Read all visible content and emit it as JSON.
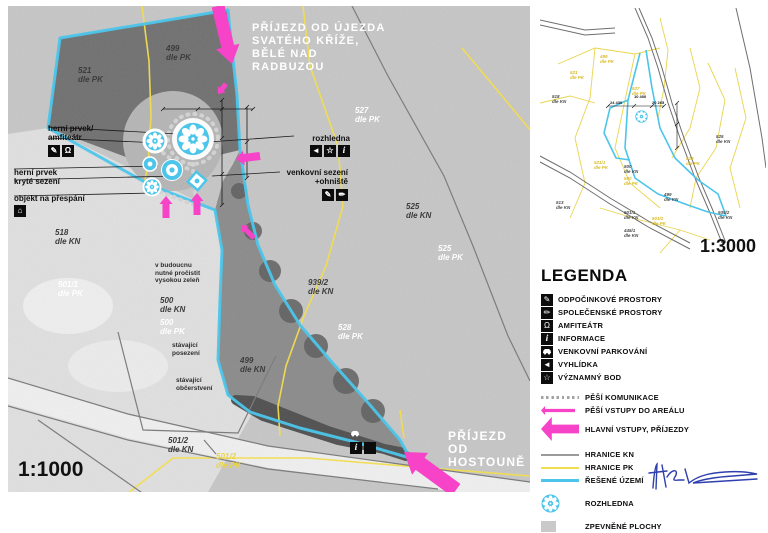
{
  "colors": {
    "magenta": "#f643c8",
    "cyan": "#4cc5ea",
    "yellow": "#f2dd4e",
    "kn_gray": "#8a8a8a",
    "photo_base": "#c6c6c6",
    "forest": "#6f6f6f",
    "paved": "#c9c9c9",
    "ink_blue": "#2f3fae"
  },
  "main_map": {
    "scale": "1:1000",
    "arrival_top": "PŘÍJEZD OD ÚJEZDA\nSVATÉHO KŘÍŽE,\nBĚLÉ NAD\nRADBUZOU",
    "arrival_bottom": "PŘÍJEZD OD\nHOSTOUNĚ",
    "parcels": [
      {
        "text": "521\ndle PK",
        "x": 70,
        "y": 60,
        "style": "dark"
      },
      {
        "text": "499\ndle PK",
        "x": 158,
        "y": 38,
        "style": "dark"
      },
      {
        "text": "527\ndle PK",
        "x": 347,
        "y": 100,
        "style": "white"
      },
      {
        "text": "525\ndle KN",
        "x": 398,
        "y": 196,
        "style": "dark"
      },
      {
        "text": "525\ndle PK",
        "x": 430,
        "y": 238,
        "style": "white"
      },
      {
        "text": "939/2\ndle KN",
        "x": 300,
        "y": 272,
        "style": "dark"
      },
      {
        "text": "528\ndle PK",
        "x": 330,
        "y": 317,
        "style": "white"
      },
      {
        "text": "518\ndle KN",
        "x": 47,
        "y": 222,
        "style": "dark"
      },
      {
        "text": "501/1\ndle PK",
        "x": 50,
        "y": 274,
        "style": "white"
      },
      {
        "text": "500\ndle KN",
        "x": 152,
        "y": 290,
        "style": "dark"
      },
      {
        "text": "500\ndle PK",
        "x": 152,
        "y": 312,
        "style": "white"
      },
      {
        "text": "499\ndle KN",
        "x": 232,
        "y": 350,
        "style": "dark"
      },
      {
        "text": "501/2\ndle KN",
        "x": 160,
        "y": 430,
        "style": "dark"
      },
      {
        "text": "501/2\ndle PK",
        "x": 208,
        "y": 446,
        "style": "yellow"
      }
    ],
    "notes": [
      {
        "text": "v budoucnu\nnutné pročistit\nvysokou zeleň",
        "x": 147,
        "y": 256
      },
      {
        "text": "stávající\nposezení",
        "x": 164,
        "y": 336
      },
      {
        "text": "stávající\nobčerstvení",
        "x": 168,
        "y": 371
      }
    ],
    "feature_labels": {
      "play_amphi": {
        "text": "herní prvek/\namfiteátr",
        "icons": [
          "rest",
          "amphi"
        ]
      },
      "play_shelter": {
        "text": "herní prvek\nkryté sezení",
        "icons": []
      },
      "overnight": {
        "text": "objekt na přespání",
        "icons": [
          "sleep"
        ]
      },
      "tower": {
        "text": "rozhledna",
        "icons": [
          "viewpoint",
          "landmark",
          "info"
        ]
      },
      "seating": {
        "text": "venkovní sezení\n+ohniště",
        "icons": [
          "rest",
          "social"
        ]
      },
      "parking": {
        "icons": [
          "info",
          "car"
        ]
      }
    }
  },
  "small_map": {
    "scale": "1:3000",
    "dim_labels": [
      {
        "text": "24 430",
        "x": 70,
        "y": 92
      },
      {
        "text": "10 400",
        "x": 94,
        "y": 86
      },
      {
        "text": "20 265",
        "x": 112,
        "y": 92
      }
    ],
    "labels": [
      {
        "text": "518\ndle KN",
        "x": 12,
        "y": 86,
        "style": "dark"
      },
      {
        "text": "521\ndle PK",
        "x": 30,
        "y": 62,
        "style": "yellow"
      },
      {
        "text": "499\ndle PK",
        "x": 60,
        "y": 46,
        "style": "yellow"
      },
      {
        "text": "527\ndle PK",
        "x": 92,
        "y": 78,
        "style": "yellow"
      },
      {
        "text": "525\ndle KN",
        "x": 176,
        "y": 126,
        "style": "dark"
      },
      {
        "text": "521/1\ndle PK",
        "x": 54,
        "y": 152,
        "style": "yellow"
      },
      {
        "text": "500\ndle KN",
        "x": 84,
        "y": 156,
        "style": "dark"
      },
      {
        "text": "500\ndle PK",
        "x": 84,
        "y": 168,
        "style": "yellow"
      },
      {
        "text": "528\ndle PK",
        "x": 146,
        "y": 148,
        "style": "yellow"
      },
      {
        "text": "499\ndle KN",
        "x": 124,
        "y": 184,
        "style": "dark"
      },
      {
        "text": "513\ndle KN",
        "x": 16,
        "y": 192,
        "style": "dark"
      },
      {
        "text": "501/1\ndle KN",
        "x": 84,
        "y": 202,
        "style": "dark"
      },
      {
        "text": "501/2\ndle PK",
        "x": 112,
        "y": 208,
        "style": "yellow"
      },
      {
        "text": "939/2\ndle KN",
        "x": 178,
        "y": 202,
        "style": "dark"
      },
      {
        "text": "445/1\ndle KN",
        "x": 84,
        "y": 220,
        "style": "dark"
      }
    ]
  },
  "legend": {
    "title": "LEGENDA",
    "items": [
      {
        "kind": "box",
        "icon": "rest",
        "label": "ODPOČINKOVÉ PROSTORY"
      },
      {
        "kind": "box",
        "icon": "social",
        "label": "SPOLEČENSKÉ PROSTORY"
      },
      {
        "kind": "box",
        "icon": "amphi",
        "label": "AMFITEÁTR"
      },
      {
        "kind": "box",
        "icon": "info",
        "label": "INFORMACE"
      },
      {
        "kind": "box",
        "icon": "car",
        "label": "VENKOVNÍ PARKOVÁNÍ"
      },
      {
        "kind": "box",
        "icon": "viewpoint",
        "label": "VYHLÍDKA"
      },
      {
        "kind": "box",
        "icon": "landmark",
        "label": "VÝZNAMNÝ BOD"
      },
      {
        "kind": "dots",
        "label": "PĚŠÍ KOMUNIKACE",
        "gap": true
      },
      {
        "kind": "arrow-small",
        "label": "PĚŠÍ VSTUPY DO AREÁLU"
      },
      {
        "kind": "arrow-big",
        "label": "HLAVNÍ VSTUPY, PŘÍJEZDY"
      },
      {
        "kind": "line-gray",
        "label": "HRANICE KN",
        "gap": true
      },
      {
        "kind": "line-yellow",
        "label": "HRANICE PK"
      },
      {
        "kind": "line-cyan",
        "label": "ŘEŠENÉ ÚZEMÍ"
      },
      {
        "kind": "flower",
        "label": "ROZHLEDNA",
        "gap": true
      },
      {
        "kind": "patch",
        "label": "ZPEVNĚNÉ PLOCHY",
        "gap": true
      }
    ]
  }
}
